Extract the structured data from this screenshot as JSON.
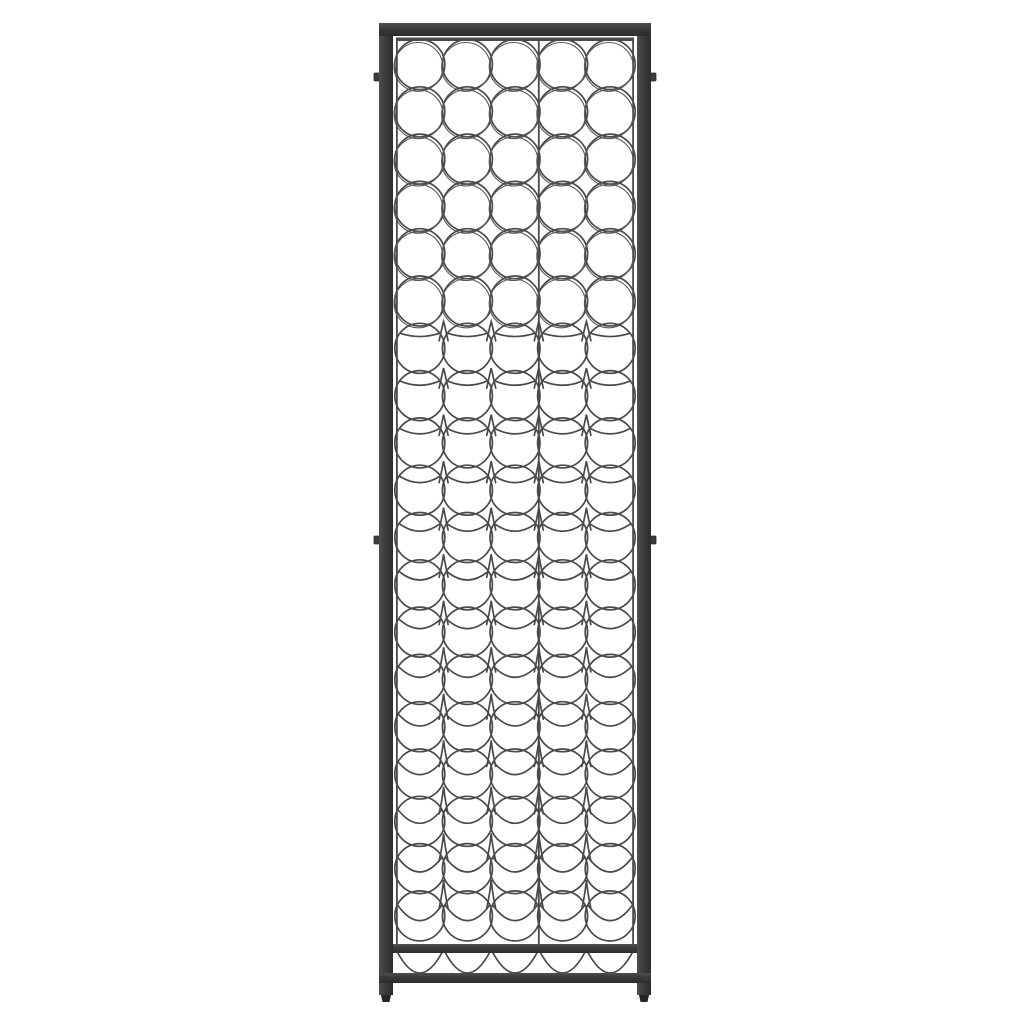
{
  "page": {
    "description": "Product photo: tall black wrought-iron wine rack, front view, centered on a plain white background. No text, labels or UI controls are visible in the image.",
    "background_color": "#ffffff"
  },
  "scene": {
    "object_name": "tall wrought-iron wine bottle rack",
    "view": "front, orthographic product shot",
    "colors": {
      "background": "#ffffff",
      "frame": "#3b3b3b",
      "frame_edge": "#2c2c2c",
      "frame_highlight": "#4f4f4f",
      "wire": "#4a4a4a",
      "wire_light": "#5a5a5a",
      "foot": "#262626"
    },
    "structure": {
      "columns": 5,
      "rows": 19,
      "under_shelf_arcs": 5,
      "panels": 2,
      "panel_split_columns": [
        3,
        2
      ],
      "wall_mount_tabs": 4
    },
    "geometry": {
      "canvas": {
        "w": 1024,
        "h": 1024
      },
      "outer_left": 379,
      "outer_right": 651,
      "post_width": 14,
      "post_bottom": 995,
      "top_bar": {
        "y": 23,
        "h": 13
      },
      "panel": {
        "left": 396,
        "right": 634,
        "top": 37.5,
        "top_bar_h": 3.5
      },
      "seam_x": 538.8,
      "shelf_bar": {
        "x": 393,
        "y": 944,
        "w": 244,
        "h": 9
      },
      "bottom_bar": {
        "x": 379,
        "y": 973,
        "w": 272,
        "h": 10
      },
      "foot": {
        "w": 10,
        "h": 7
      },
      "tabs": {
        "w": 5,
        "h": 8,
        "y_top": 73,
        "y_mid": 536
      },
      "circles": {
        "radius": 25,
        "col_start_cx": 419.8,
        "col_pitch": 47.6,
        "row_start_cy": 64.5,
        "row_pitch": 47.3,
        "stroke_width": 1.7,
        "plain_rows_until": 5
      },
      "under_arc": {
        "half_w": 23,
        "top_y": 951,
        "ctrl_y": 995
      }
    }
  }
}
